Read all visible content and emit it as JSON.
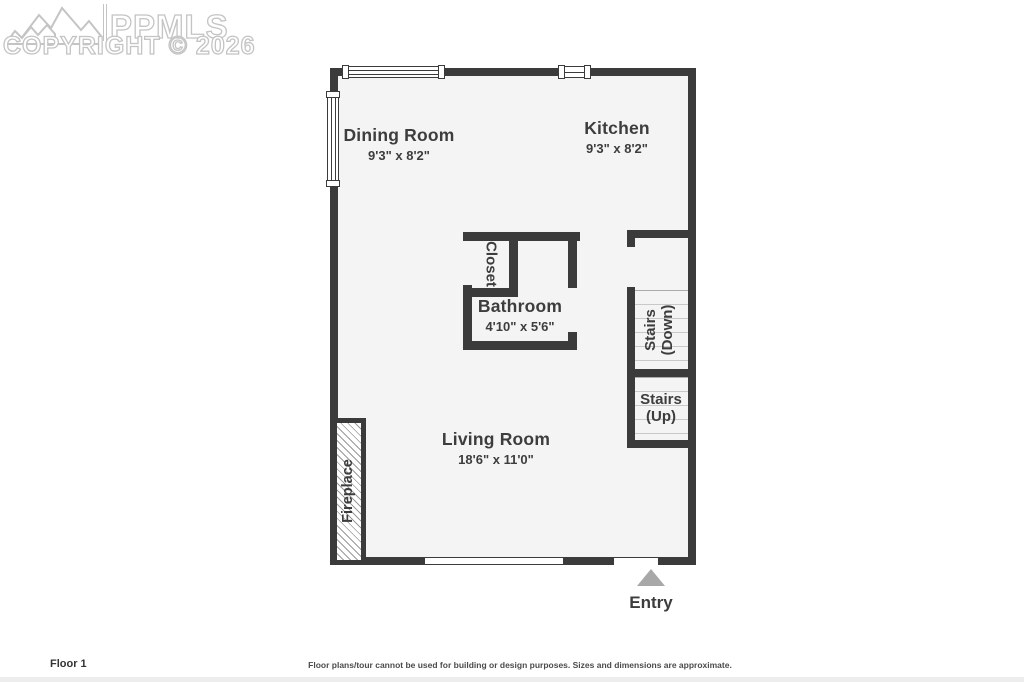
{
  "watermark": {
    "brand": "PPMLS",
    "copyright_line": "COPYRIGHT © 2026",
    "logo": "mountain-range-icon"
  },
  "plan": {
    "dining_room": {
      "name": "Dining Room",
      "dims": "9'3\" x 8'2\""
    },
    "kitchen": {
      "name": "Kitchen",
      "dims": "9'3\" x 8'2\""
    },
    "bathroom": {
      "name": "Bathroom",
      "dims": "4'10\" x 5'6\""
    },
    "living_room": {
      "name": "Living Room",
      "dims": "18'6\" x 11'0\""
    },
    "closet": {
      "name": "Closet"
    },
    "stairs_down": {
      "line1": "Stairs",
      "line2": "(Down)"
    },
    "stairs_up": {
      "line1": "Stairs",
      "line2": "(Up)"
    },
    "fireplace": {
      "name": "Fireplace"
    },
    "entry": {
      "label": "Entry"
    }
  },
  "footer": {
    "floor_label": "Floor 1",
    "disclaimer": "Floor plans/tour cannot be used for building or design purposes. Sizes and dimensions are approximate."
  },
  "colors": {
    "wall": "#3b3b3b",
    "floor": "#f4f4f4",
    "label_text": "#3d3d3d",
    "entry_arrow": "#a8a8a8",
    "watermark_outline": "#c4c4c4",
    "stair_tread_line": "#c9c9c9"
  }
}
